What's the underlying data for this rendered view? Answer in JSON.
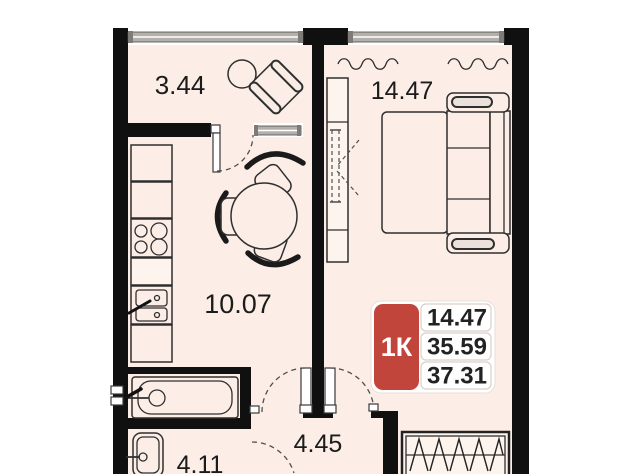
{
  "rooms": {
    "balcony": {
      "area": "3.44"
    },
    "bedroom": {
      "area": "14.47"
    },
    "kitchen_living": {
      "area": "10.07"
    },
    "hallway": {
      "area": "4.45"
    },
    "bathroom": {
      "area": "4.11"
    }
  },
  "badge": {
    "type": "1К",
    "values": [
      "14.47",
      "35.59",
      "37.31"
    ],
    "accent_color": "#c2453c"
  },
  "colors": {
    "floor": "#fceee7",
    "wall": "#101010",
    "window": "#b3afac",
    "accent": "#c2453c"
  }
}
